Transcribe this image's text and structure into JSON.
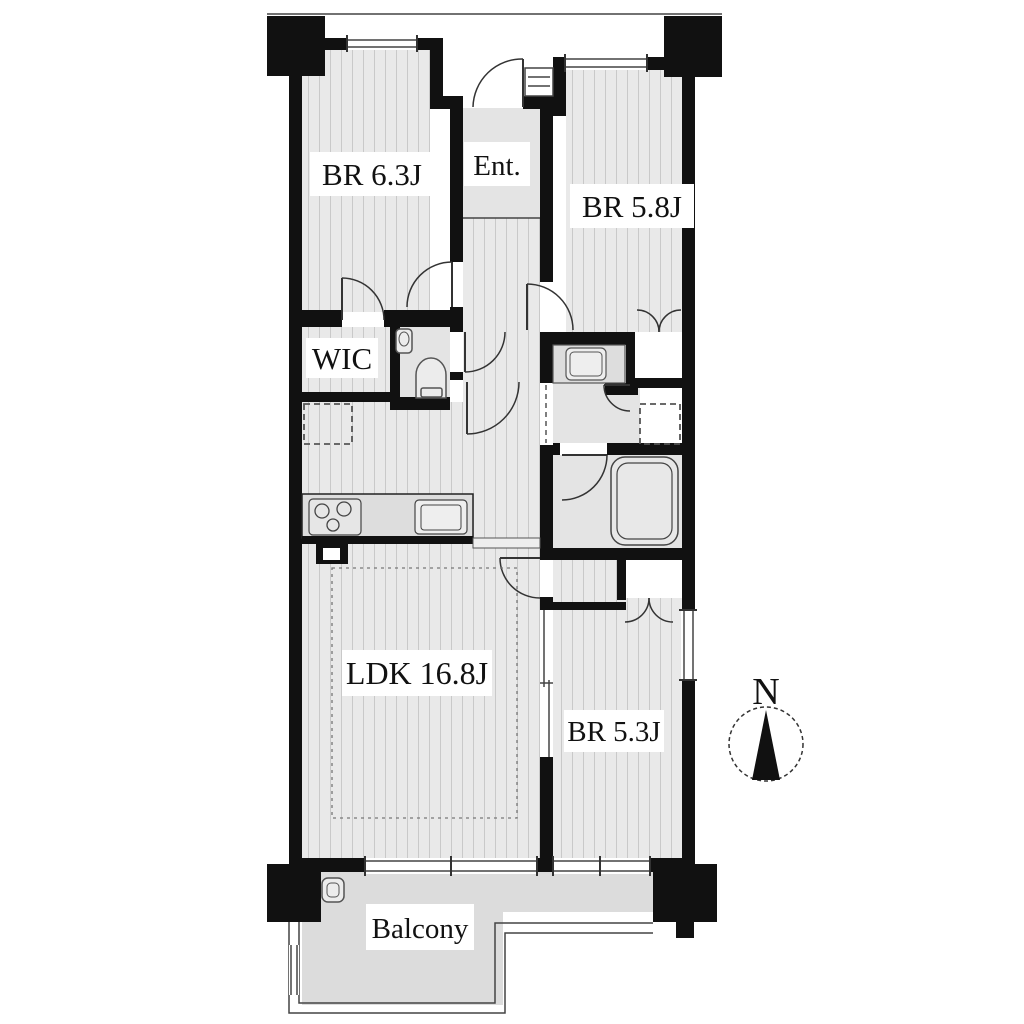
{
  "rooms": {
    "br63": {
      "label": "BR 6.3J"
    },
    "ent": {
      "label": "Ent."
    },
    "br58": {
      "label": "BR 5.8J"
    },
    "wic": {
      "label": "WIC"
    },
    "ldk": {
      "label": "LDK 16.8J"
    },
    "br53": {
      "label": "BR 5.3J"
    },
    "balcony": {
      "label": "Balcony"
    }
  },
  "compass": {
    "label": "N"
  },
  "colors": {
    "wall": "#111111",
    "floor_stripe_bg": "#e9e9e9",
    "floor_stripe": "#c9c9c9",
    "floor_plain": "#e4e4e4",
    "balcony_floor": "#dcdcdc",
    "closet": "#ffffff",
    "line": "#333333"
  }
}
